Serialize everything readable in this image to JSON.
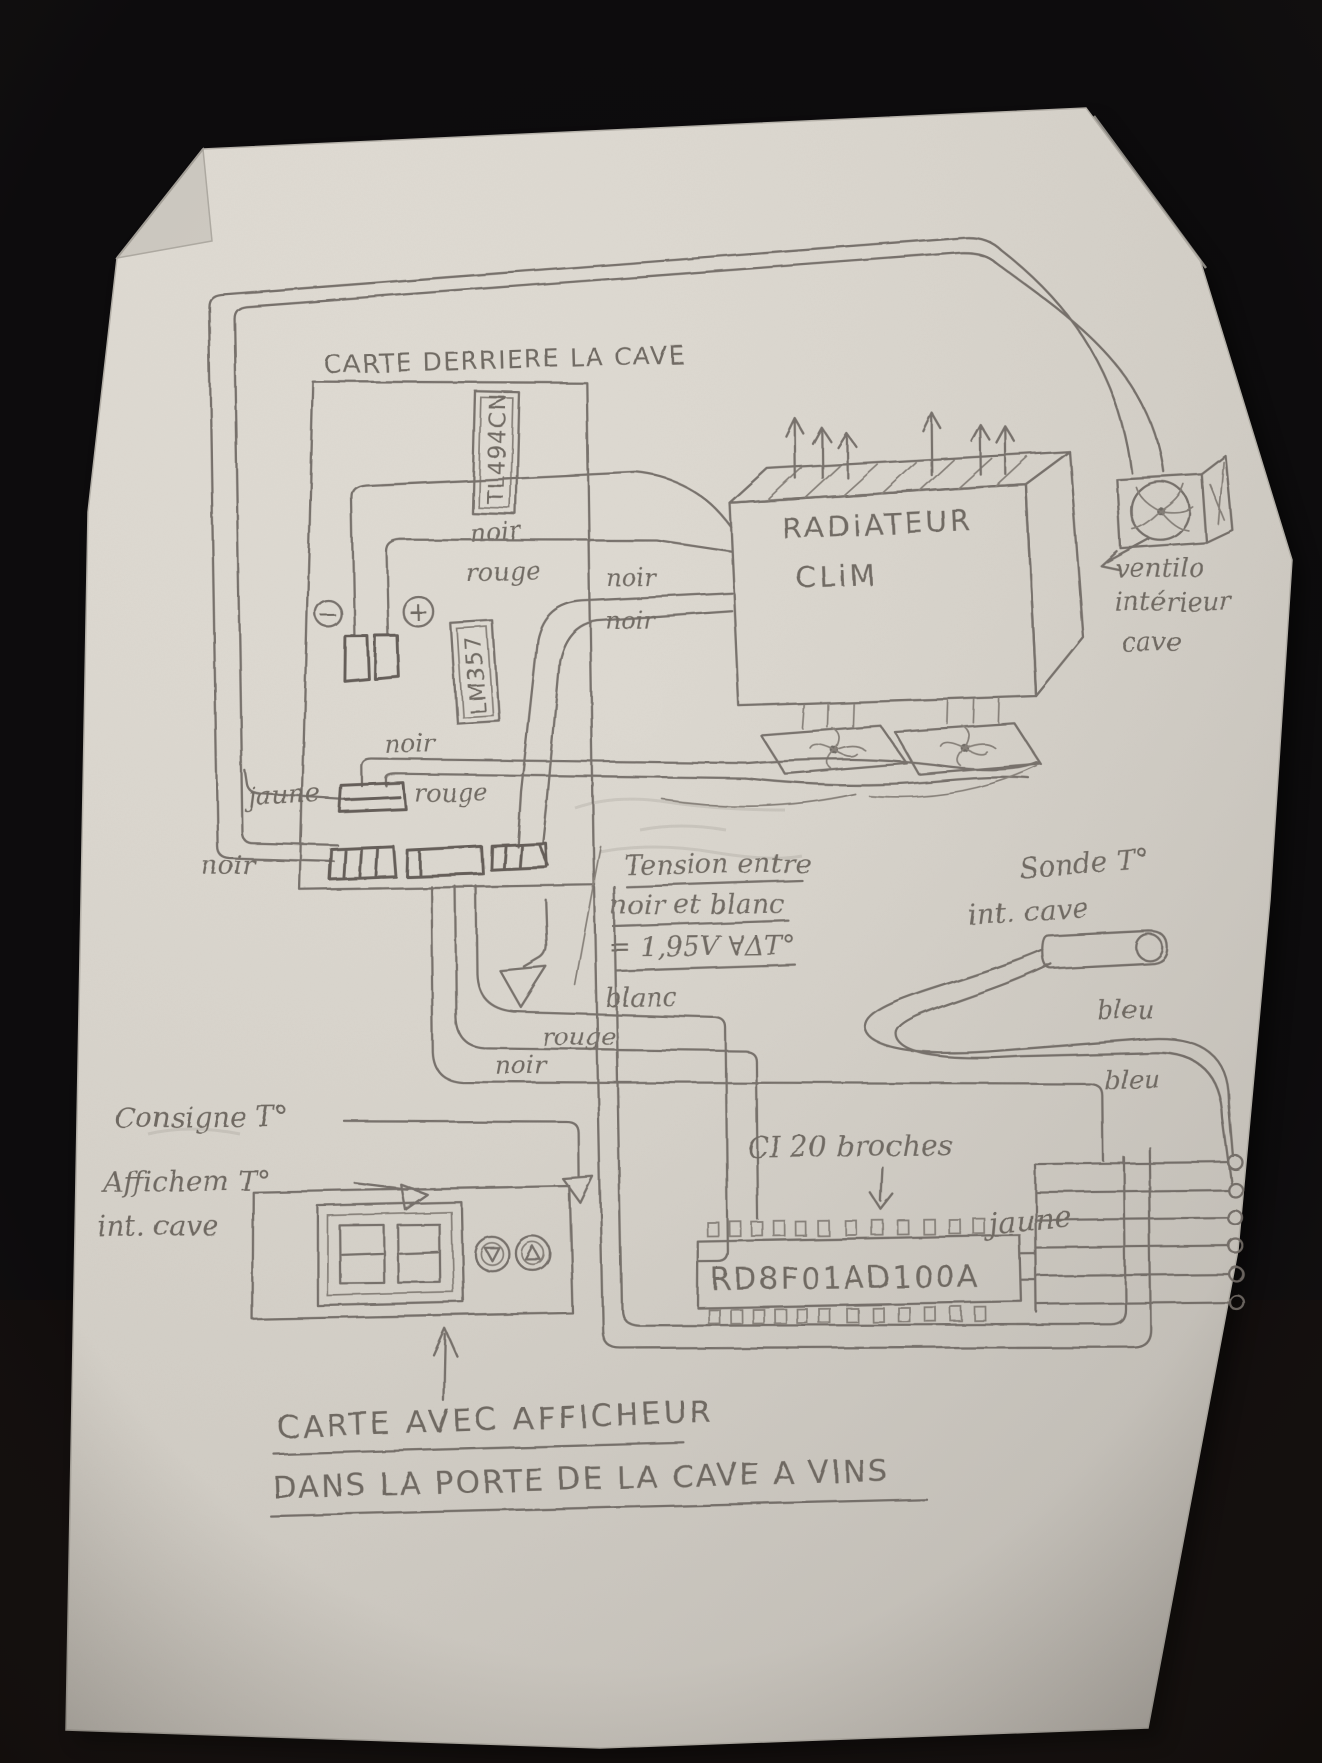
{
  "meta": {
    "scene": "pencil hand-drawn wiring schematic on paper, photographed on a dark table",
    "paper_color": "#dedad2",
    "pencil_color": "#6b6660",
    "background_color": "#0a090b"
  },
  "back_card": {
    "title": "CARTE DERRIERE LA CAVE",
    "ic_pwm": "TL494CN",
    "ic_sensor": "LM357",
    "polarity_minus": "−",
    "polarity_plus": "+"
  },
  "radiator": {
    "label_line1": "RADiATEUR",
    "label_line2": "CLiM"
  },
  "interior_fan": {
    "caption_line1": "ventilo",
    "caption_line2": "intérieur",
    "caption_line3": "cave"
  },
  "probe": {
    "label_line1": "Sonde T°",
    "label_line2": "int. cave",
    "wire_color_1": "bleu",
    "wire_color_2": "bleu"
  },
  "voltage_note": {
    "line1": "Tension entre",
    "line2": "noir et blanc",
    "line3": "= 1,95V  ∀ΔT°"
  },
  "wire_labels": {
    "noir_top": "noir",
    "rouge_top": "rouge",
    "noir_mid_upper": "noir",
    "noir_mid_lower": "noir",
    "noir_connector": "noir",
    "rouge_connector": "rouge",
    "jaune_left": "jaune",
    "noir_bottom_left": "noir",
    "blanc": "blanc",
    "rouge_lower": "rouge",
    "noir_lower": "noir",
    "jaune_right": "jaune"
  },
  "display_card": {
    "annotation_consigne": "Consigne T°",
    "annotation_affichage_line1": "Affichem T°",
    "annotation_affichage_line2": "int. cave",
    "display_digits": "88",
    "button_down_glyph": "▽",
    "button_up_glyph": "△",
    "caption_line1": "CARTE AVEC AFFICHEUR",
    "caption_line2": "DANS LA PORTE DE LA CAVE A VINS"
  },
  "ic_board": {
    "note": "CI 20 broches",
    "chip_label": "RD8F01AD100A"
  }
}
